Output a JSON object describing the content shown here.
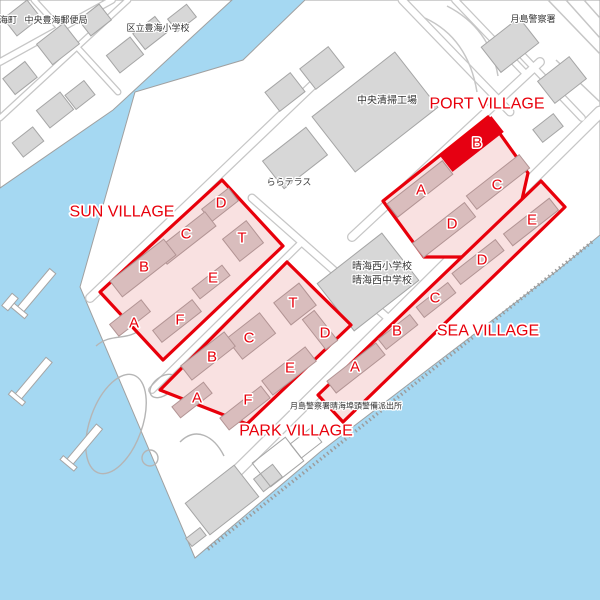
{
  "map": {
    "width": 600,
    "height": 600,
    "colors": {
      "water": "#a5d8f2",
      "land": "#ffffff",
      "land_stroke": "#a0a0a0",
      "road_casing": "#c6c6c6",
      "road_fill": "#ffffff",
      "block_fill": "#d7d7d7",
      "block_stroke": "#a5a5a5",
      "zone_fill": "#f9e1e1",
      "zone_stroke": "#e8000b",
      "zone_building_fill": "#d9bdbd",
      "zone_building_stroke": "#b29494",
      "highlight_fill": "#e60012",
      "red_text": "#e8000b",
      "dark_text": "#333333",
      "park_path": "#b5b5b5",
      "hatch": "#9c9c9c"
    },
    "land": {
      "toyomi": "0,0 232,0 113,110 0,188",
      "harumi": "305,0 600,0 600,235 558,270 320,452 195,558 80,287 135,92 243,60"
    },
    "hatch_line": {
      "x1": 592,
      "y1": 242,
      "x2": 207,
      "y2": 550
    },
    "roads": [
      {
        "x1": 600,
        "y1": 112,
        "x2": 236,
        "y2": 472,
        "w": 13
      },
      {
        "x1": 540,
        "y1": 62,
        "x2": 352,
        "y2": 237,
        "w": 10
      },
      {
        "x1": 318,
        "y1": 80,
        "x2": 90,
        "y2": 298,
        "w": 10
      },
      {
        "x1": 300,
        "y1": 244,
        "x2": 152,
        "y2": 390,
        "w": 8
      },
      {
        "x1": 252,
        "y1": 198,
        "x2": 390,
        "y2": 320,
        "w": 9
      },
      {
        "x1": 522,
        "y1": 55,
        "x2": 582,
        "y2": 118,
        "w": 8
      },
      {
        "x1": 402,
        "y1": 0,
        "x2": 510,
        "y2": 112,
        "w": 9
      },
      {
        "x1": 455,
        "y1": 0,
        "x2": 524,
        "y2": 72,
        "w": 8
      },
      {
        "x1": 0,
        "y1": 62,
        "x2": 112,
        "y2": 0,
        "w": 8
      },
      {
        "x1": 34,
        "y1": 0,
        "x2": 118,
        "y2": 92,
        "w": 7
      },
      {
        "x1": 0,
        "y1": 118,
        "x2": 128,
        "y2": 0,
        "w": 7
      }
    ],
    "deco_paths": [
      "M425,18 Q468,38 477,92",
      "M447,6 Q490,28 498,76",
      "M548,0 L600,54",
      "M566,0 L600,38",
      "M584,0 L600,18",
      "M556,60 L600,102"
    ],
    "blocks": [
      {
        "cx": 22,
        "cy": 18,
        "w": 30,
        "h": 22,
        "rot": -38
      },
      {
        "cx": 58,
        "cy": 44,
        "w": 34,
        "h": 26,
        "rot": -38
      },
      {
        "cx": 20,
        "cy": 78,
        "w": 28,
        "h": 20,
        "rot": -38
      },
      {
        "cx": 95,
        "cy": 20,
        "w": 26,
        "h": 20,
        "rot": -38
      },
      {
        "cx": 125,
        "cy": 55,
        "w": 30,
        "h": 22,
        "rot": -38
      },
      {
        "cx": 55,
        "cy": 110,
        "w": 30,
        "h": 22,
        "rot": -38
      },
      {
        "cx": 28,
        "cy": 142,
        "w": 26,
        "h": 18,
        "rot": -38
      },
      {
        "cx": 80,
        "cy": 95,
        "w": 24,
        "h": 18,
        "rot": -38
      },
      {
        "cx": 150,
        "cy": 33,
        "w": 28,
        "h": 20,
        "rot": -38
      },
      {
        "cx": 182,
        "cy": 18,
        "w": 24,
        "h": 16,
        "rot": -38
      },
      {
        "cx": 285,
        "cy": 92,
        "w": 32,
        "h": 24,
        "rot": -38
      },
      {
        "cx": 322,
        "cy": 68,
        "w": 36,
        "h": 26,
        "rot": -38
      },
      {
        "cx": 375,
        "cy": 112,
        "w": 105,
        "h": 70,
        "rot": -38
      },
      {
        "cx": 295,
        "cy": 158,
        "w": 55,
        "h": 35,
        "rot": -38
      },
      {
        "cx": 510,
        "cy": 45,
        "w": 48,
        "h": 32,
        "rot": -38
      },
      {
        "cx": 562,
        "cy": 80,
        "w": 40,
        "h": 28,
        "rot": -38
      },
      {
        "cx": 548,
        "cy": 128,
        "w": 26,
        "h": 16,
        "rot": -38
      },
      {
        "cx": 368,
        "cy": 282,
        "w": 82,
        "h": 60,
        "rot": -38
      },
      {
        "cx": 222,
        "cy": 500,
        "w": 62,
        "h": 40,
        "rot": -38
      },
      {
        "cx": 268,
        "cy": 478,
        "w": 24,
        "h": 16,
        "rot": -38
      },
      {
        "cx": 196,
        "cy": 537,
        "w": 18,
        "h": 10,
        "rot": -38
      }
    ],
    "outline_blocks": [
      {
        "cx": 278,
        "cy": 462,
        "w": 42,
        "h": 30,
        "rot": -38
      },
      {
        "cx": 306,
        "cy": 443,
        "w": 26,
        "h": 18,
        "rot": -38
      }
    ],
    "park_shapes": [
      {
        "type": "ellipse",
        "cx": 116,
        "cy": 424,
        "rx": 26,
        "ry": 52,
        "rot": 20
      },
      {
        "type": "ellipse",
        "cx": 163,
        "cy": 386,
        "rx": 15,
        "ry": 9,
        "rot": -38
      },
      {
        "type": "circle",
        "cx": 150,
        "cy": 458,
        "r": 8
      },
      {
        "type": "path",
        "d": "M180,442 C196,426 214,436 224,456"
      },
      {
        "type": "path",
        "d": "M96,346 C112,332 128,342 142,328"
      }
    ],
    "piers": [
      {
        "cx": 36,
        "cy": 291,
        "len": 52,
        "cap": true
      },
      {
        "cx": 33,
        "cy": 379,
        "len": 50,
        "cap": true
      },
      {
        "cx": 84,
        "cy": 445,
        "len": 48,
        "cap": true
      },
      {
        "cx": 10,
        "cy": 302,
        "len": 16,
        "cap": false
      }
    ],
    "villages": [
      {
        "id": "port",
        "name": "PORT VILLAGE",
        "label_x": 487,
        "label_y": 104,
        "zone": "488,117 528,173 509,257 424,257 383,201",
        "buildings": [
          {
            "label": "A",
            "cx": 420,
            "cy": 189,
            "w": 70,
            "h": 17,
            "rot": -38,
            "lx": 421,
            "ly": 190,
            "highlight": false
          },
          {
            "label": "B",
            "cx": 472,
            "cy": 144,
            "w": 64,
            "h": 19,
            "rot": -38,
            "lx": 477,
            "ly": 143,
            "highlight": true
          },
          {
            "label": "C",
            "cx": 498,
            "cy": 182,
            "w": 67,
            "h": 17,
            "rot": -38,
            "lx": 497,
            "ly": 185,
            "highlight": false
          },
          {
            "label": "D",
            "cx": 444,
            "cy": 230,
            "w": 66,
            "h": 18,
            "rot": -38,
            "lx": 452,
            "ly": 224,
            "highlight": false
          }
        ]
      },
      {
        "id": "sun",
        "name": "SUN VILLAGE",
        "label_x": 122,
        "label_y": 212,
        "zone": "222,180 283,246 163,360 100,292",
        "buildings": [
          {
            "label": "D",
            "cx": 220,
            "cy": 205,
            "w": 34,
            "h": 16,
            "rot": -38,
            "lx": 221,
            "ly": 203,
            "highlight": false
          },
          {
            "label": "C",
            "cx": 186,
            "cy": 238,
            "w": 62,
            "h": 18,
            "rot": -38,
            "lx": 186,
            "ly": 234,
            "highlight": false
          },
          {
            "label": "T",
            "cx": 243,
            "cy": 241,
            "w": 30,
            "h": 28,
            "rot": -38,
            "lx": 242,
            "ly": 238,
            "highlight": false
          },
          {
            "label": "B",
            "cx": 143,
            "cy": 268,
            "w": 68,
            "h": 20,
            "rot": -38,
            "lx": 144,
            "ly": 267,
            "highlight": false
          },
          {
            "label": "E",
            "cx": 211,
            "cy": 282,
            "w": 38,
            "h": 13,
            "rot": -38,
            "lx": 213,
            "ly": 278,
            "highlight": false
          },
          {
            "label": "A",
            "cx": 130,
            "cy": 318,
            "w": 40,
            "h": 15,
            "rot": -38,
            "lx": 134,
            "ly": 323,
            "highlight": false
          },
          {
            "label": "F",
            "cx": 177,
            "cy": 321,
            "w": 50,
            "h": 15,
            "rot": -38,
            "lx": 180,
            "ly": 320,
            "highlight": false
          }
        ]
      },
      {
        "id": "park",
        "name": "PARK VILLAGE",
        "label_x": 296,
        "label_y": 431,
        "zone": "287,262 351,325 247,424 160,390",
        "buildings": [
          {
            "label": "T",
            "cx": 295,
            "cy": 304,
            "w": 32,
            "h": 28,
            "rot": -38,
            "lx": 293,
            "ly": 303,
            "highlight": false
          },
          {
            "label": "C",
            "cx": 251,
            "cy": 336,
            "w": 42,
            "h": 26,
            "rot": -38,
            "lx": 249,
            "ly": 338,
            "highlight": false
          },
          {
            "label": "D",
            "cx": 320,
            "cy": 330,
            "w": 38,
            "h": 15,
            "rot": 52,
            "lx": 325,
            "ly": 333,
            "highlight": false
          },
          {
            "label": "B",
            "cx": 208,
            "cy": 356,
            "w": 55,
            "h": 18,
            "rot": -38,
            "lx": 212,
            "ly": 357,
            "highlight": false
          },
          {
            "label": "E",
            "cx": 289,
            "cy": 371,
            "w": 55,
            "h": 18,
            "rot": -38,
            "lx": 290,
            "ly": 368,
            "highlight": false
          },
          {
            "label": "A",
            "cx": 192,
            "cy": 400,
            "w": 40,
            "h": 14,
            "rot": -38,
            "lx": 197,
            "ly": 398,
            "highlight": false
          },
          {
            "label": "F",
            "cx": 245,
            "cy": 408,
            "w": 52,
            "h": 15,
            "rot": -38,
            "lx": 248,
            "ly": 400,
            "highlight": false
          }
        ]
      },
      {
        "id": "sea",
        "name": "SEA VILLAGE",
        "label_x": 488,
        "label_y": 331,
        "zone": "541,181 565,207 343,422 318,395",
        "buildings": [
          {
            "label": "E",
            "cx": 531,
            "cy": 222,
            "w": 58,
            "h": 15,
            "rot": -38,
            "lx": 532,
            "ly": 220,
            "highlight": false
          },
          {
            "label": "D",
            "cx": 478,
            "cy": 262,
            "w": 55,
            "h": 14,
            "rot": -38,
            "lx": 482,
            "ly": 260,
            "highlight": false
          },
          {
            "label": "C",
            "cx": 436,
            "cy": 300,
            "w": 40,
            "h": 13,
            "rot": -38,
            "lx": 435,
            "ly": 298,
            "highlight": false
          },
          {
            "label": "B",
            "cx": 398,
            "cy": 332,
            "w": 40,
            "h": 13,
            "rot": -38,
            "lx": 397,
            "ly": 331,
            "highlight": false
          },
          {
            "label": "A",
            "cx": 356,
            "cy": 368,
            "w": 62,
            "h": 15,
            "rot": -38,
            "lx": 355,
            "ly": 367,
            "highlight": false
          }
        ]
      }
    ],
    "place_labels": [
      {
        "text": "海町",
        "x": 8,
        "y": 20,
        "size": 9
      },
      {
        "text": "中央豊海郵便局",
        "x": 56,
        "y": 20,
        "size": 9
      },
      {
        "text": "区立豊海小学校",
        "x": 158,
        "y": 28,
        "size": 9
      },
      {
        "text": "月島警察署",
        "x": 533,
        "y": 19,
        "size": 9
      },
      {
        "text": "中央清掃工場",
        "x": 387,
        "y": 101,
        "size": 10
      },
      {
        "text": "ららテラス",
        "x": 289,
        "y": 182,
        "size": 9
      },
      {
        "text": "晴海西小学校",
        "x": 382,
        "y": 267,
        "size": 10
      },
      {
        "text": "晴海西中学校",
        "x": 382,
        "y": 281,
        "size": 10
      },
      {
        "text": "月島警察署晴海埠頭警備派出所",
        "x": 346,
        "y": 406,
        "size": 8
      }
    ]
  }
}
